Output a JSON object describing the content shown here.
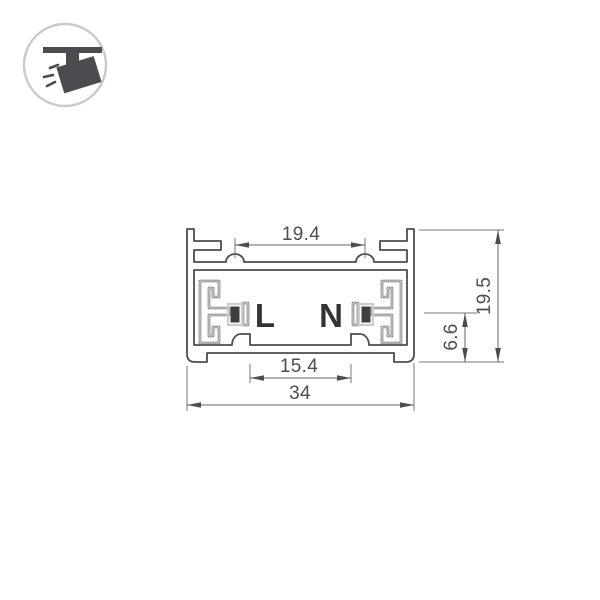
{
  "page": {
    "background": "#ffffff"
  },
  "logo": {
    "icon": "track-spotlight-icon",
    "ring_color": "#c8cacb",
    "icon_color": "#4b4b50"
  },
  "diagram": {
    "type": "technical_drawing",
    "labels": {
      "live": "L",
      "neutral": "N"
    },
    "dimensions": {
      "top_inner_width": "19.4",
      "bottom_inner_width": "15.4",
      "overall_width": "34",
      "conductor_height": "6.6",
      "overall_height": "19.5"
    },
    "colors": {
      "outline": "#4d4d4d",
      "dimension_line": "#606060",
      "dimension_text": "#4d4d4d",
      "label_text": "#333333",
      "conductor_fill": "#3f3f3f",
      "insulator_line": "#6e6e6e",
      "background": "#ffffff"
    }
  }
}
